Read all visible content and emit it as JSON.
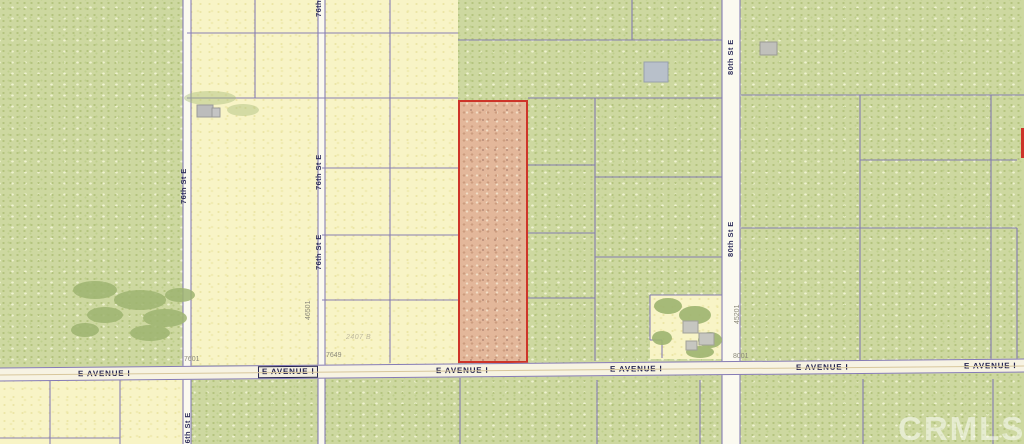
{
  "watermark": "CRMLS",
  "avenue": {
    "name": "E AVENUE I",
    "positions": [
      {
        "x": 78,
        "boxed": false
      },
      {
        "x": 258,
        "boxed": true
      },
      {
        "x": 436,
        "boxed": false
      },
      {
        "x": 610,
        "boxed": false
      },
      {
        "x": 796,
        "boxed": false
      },
      {
        "x": 964,
        "boxed": false
      }
    ]
  },
  "street_labels": [
    {
      "text": "76th St E",
      "x": 179,
      "y": 156,
      "len": 60
    },
    {
      "text": "76th St E",
      "x": 314,
      "y": -30,
      "len": 58
    },
    {
      "text": "76th St E",
      "x": 314,
      "y": 150,
      "len": 44
    },
    {
      "text": "76th St E",
      "x": 314,
      "y": 230,
      "len": 44
    },
    {
      "text": "80th St E",
      "x": 726,
      "y": 26,
      "len": 62
    },
    {
      "text": "80th St E",
      "x": 726,
      "y": 212,
      "len": 54
    },
    {
      "text": "76th St E",
      "x": 183,
      "y": 402,
      "len": 56
    }
  ],
  "addresses": [
    {
      "text": "7601",
      "x": 184,
      "y": 356,
      "vertical": false
    },
    {
      "text": "7649",
      "x": 326,
      "y": 352,
      "vertical": false
    },
    {
      "text": "8001",
      "x": 733,
      "y": 353,
      "vertical": false
    },
    {
      "text": "46501",
      "x": 305,
      "y": 288,
      "vertical": true,
      "len": 32
    },
    {
      "text": "45201",
      "x": 734,
      "y": 292,
      "vertical": true,
      "len": 32
    }
  ],
  "parcel_note": {
    "text": "2407 B"
  },
  "highlight_parcel": {
    "outline": "#cd3429",
    "fill": "#e3b79a"
  },
  "colors": {
    "parcel_line": "#7e74b2",
    "field_yellow": "#f8f4c6",
    "field_green": "#cdd8a0",
    "road_fill": "#fbfaf0",
    "avenue_fill": "#f7f3e3",
    "label_navy": "#23234f",
    "address_gray": "#8c8a7b",
    "tree_green": "#9eb470",
    "building_gray": "#bcbcbc"
  }
}
